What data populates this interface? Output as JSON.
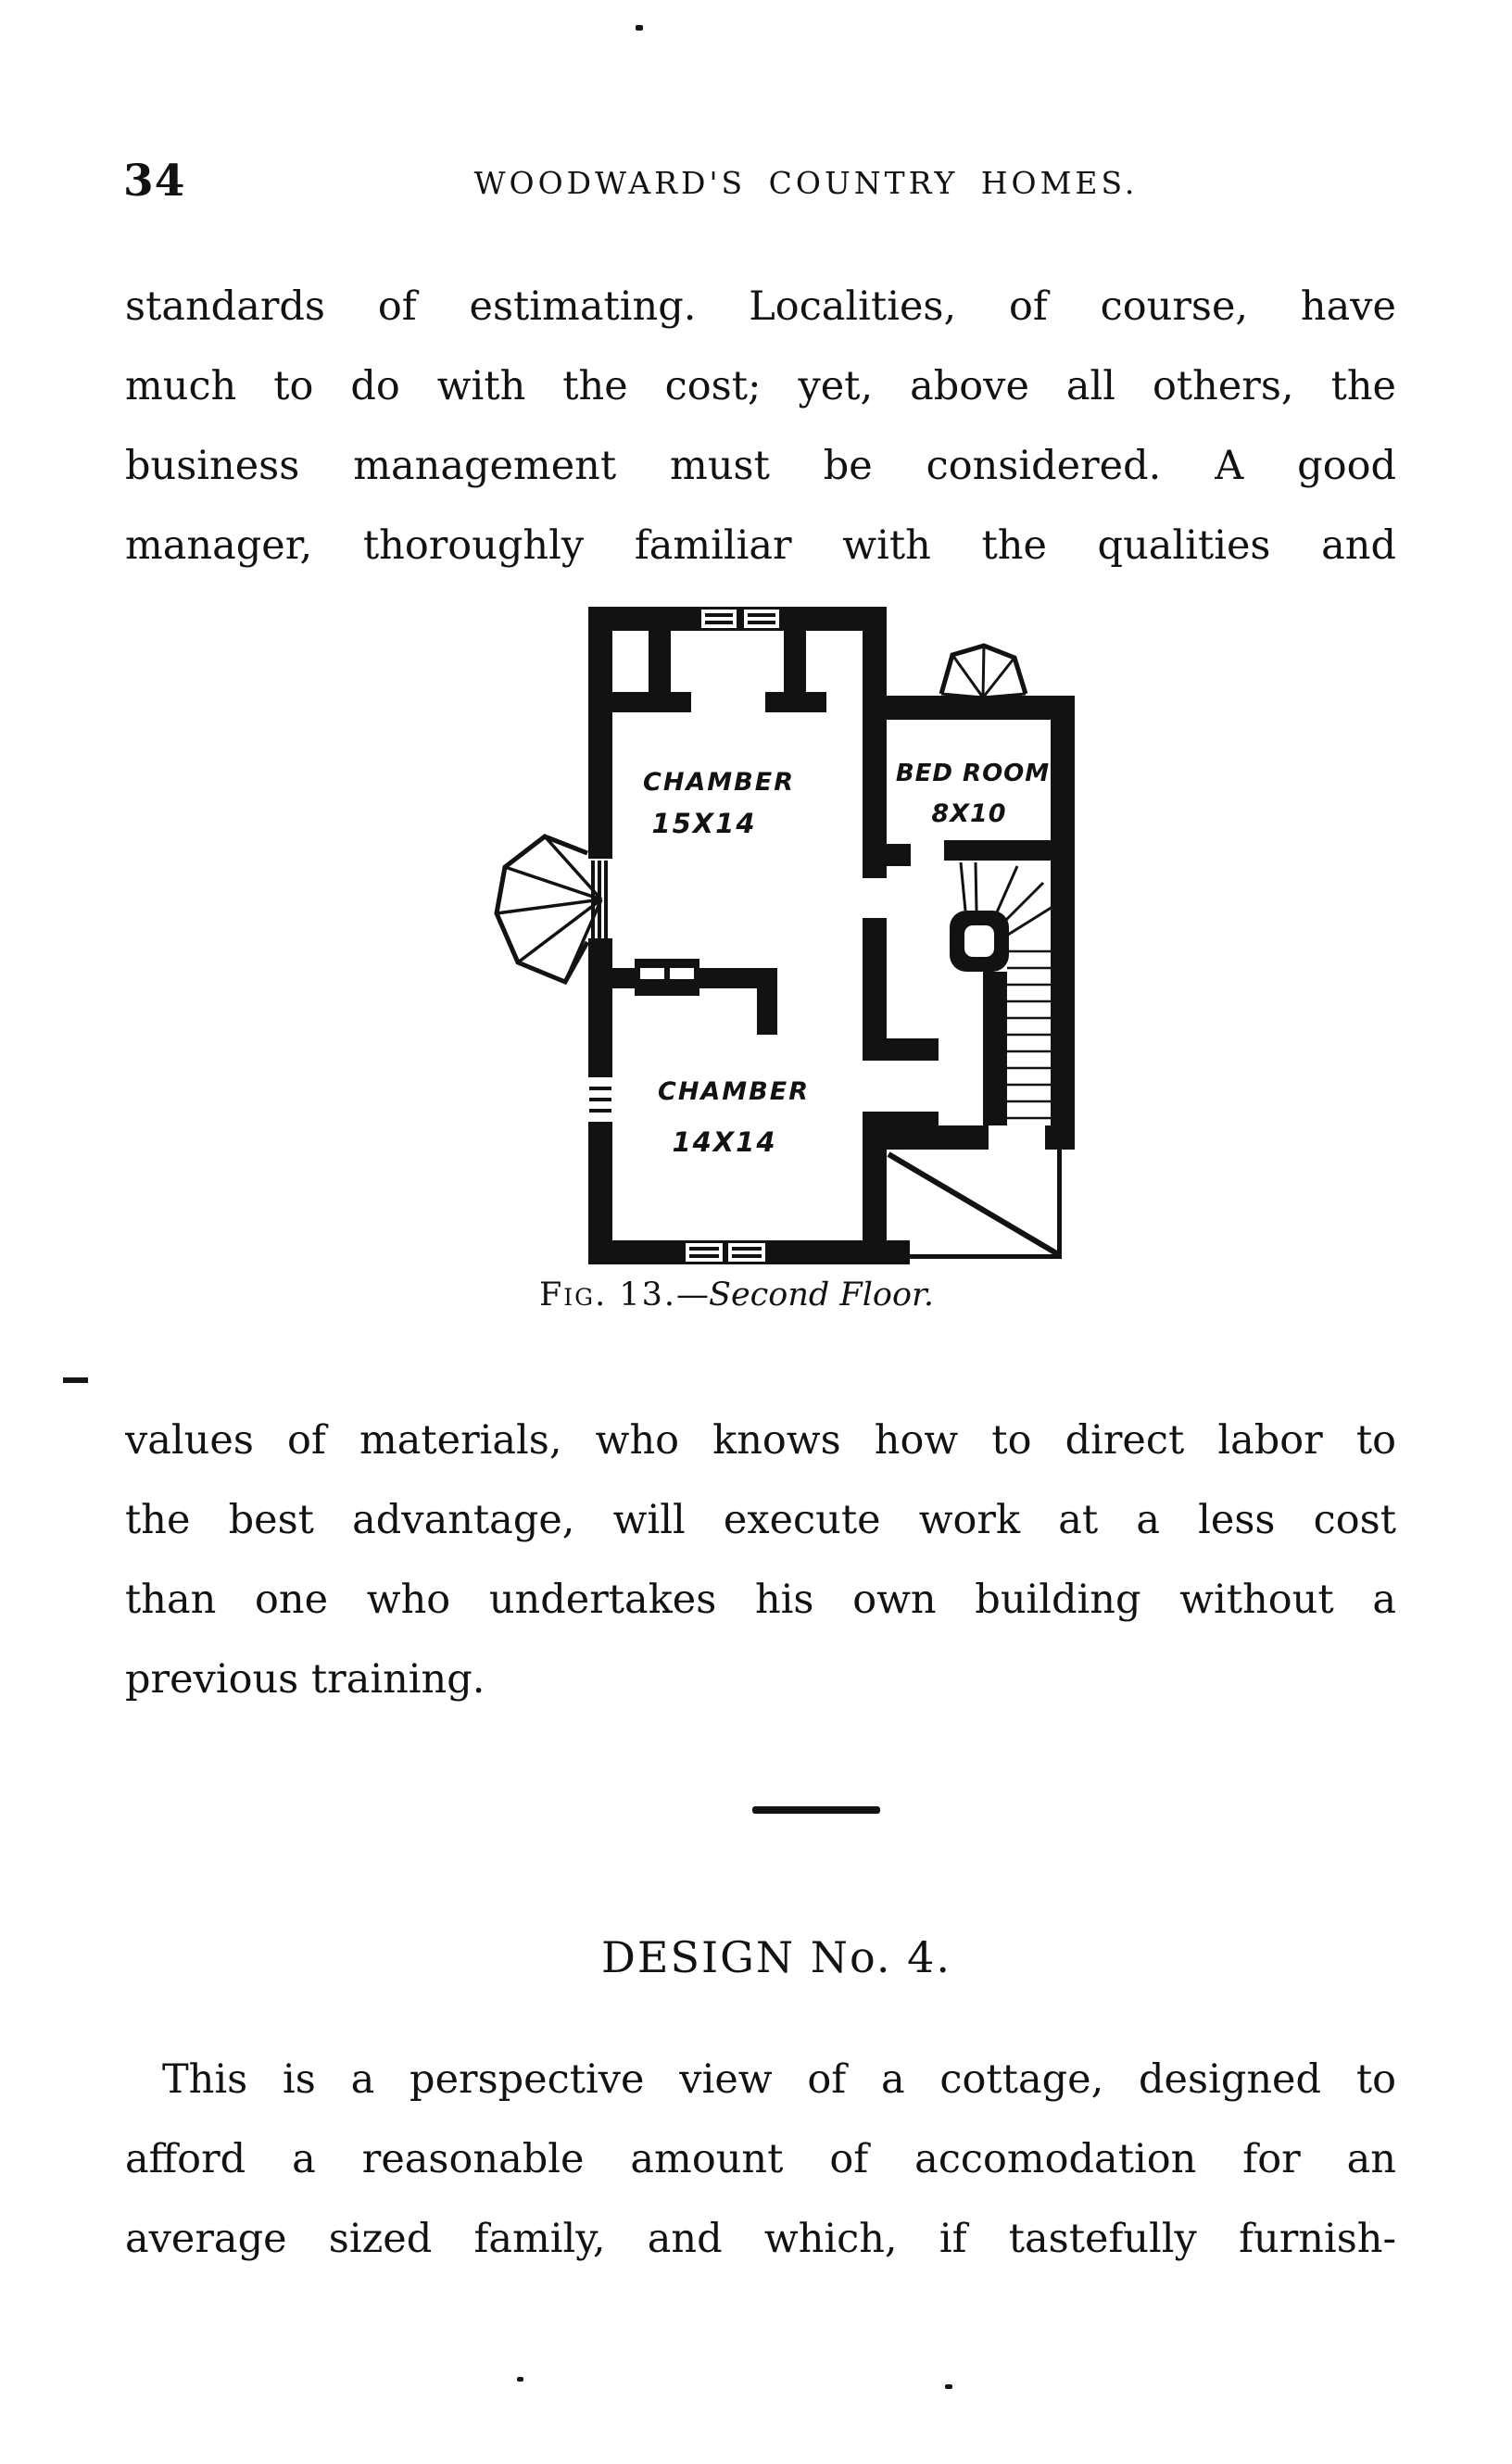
{
  "page": {
    "number": "34",
    "running_header": "WOODWARD'S COUNTRY HOMES."
  },
  "paragraphs": {
    "p1": {
      "lines": [
        "standards of estimating.  Localities, of course, have",
        "much to do with the cost; yet, above all others, the",
        "business management must be considered.  A good",
        "manager, thoroughly familiar with the qualities and"
      ]
    },
    "p2": {
      "lines": [
        "values of materials, who knows how to direct labor to",
        "the best advantage, will execute work at a less cost",
        "than one who undertakes his own building without a",
        "previous training."
      ]
    },
    "p3": {
      "lines": [
        "This is a perspective view of a cottage, designed to",
        "afford a reasonable amount of accomodation for an",
        "average sized family, and which, if tastefully furnish-"
      ]
    }
  },
  "figure": {
    "caption": {
      "fig_label": "Fig. 13.",
      "separator": "—",
      "title": "Second Floor."
    },
    "rooms": [
      {
        "name": "CHAMBER",
        "size": "15X14"
      },
      {
        "name": "BED ROOM",
        "size": "8X10"
      },
      {
        "name": "CHAMBER",
        "size": "14X14"
      }
    ]
  },
  "section": {
    "heading": "DESIGN No. 4."
  },
  "colors": {
    "ink": "#121212",
    "paper": "#ffffff"
  }
}
